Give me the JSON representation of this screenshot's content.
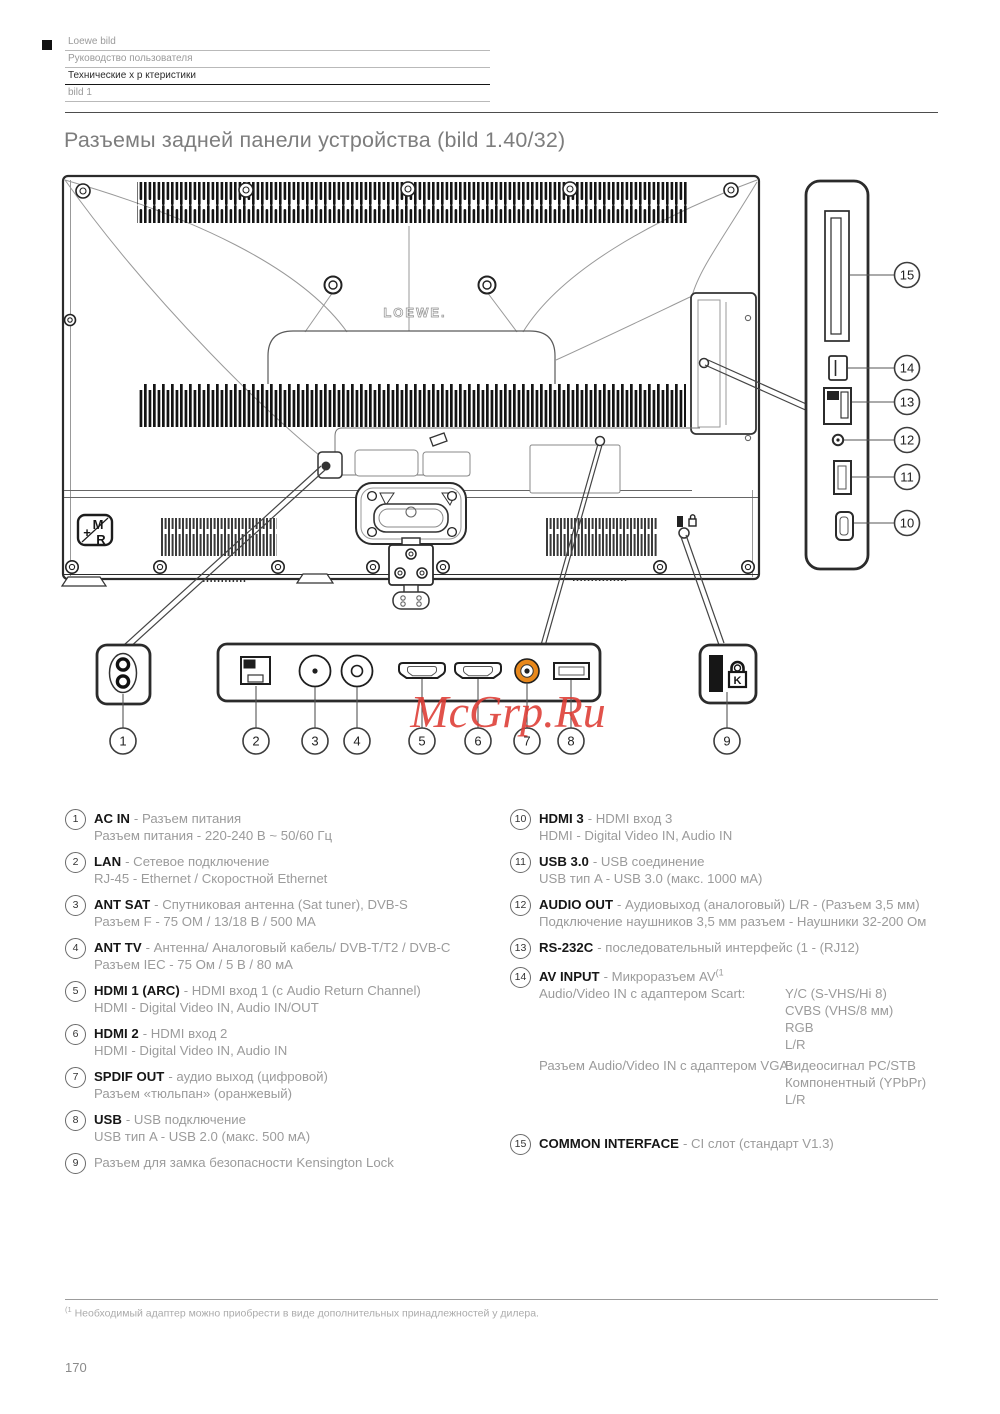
{
  "header": {
    "rows": [
      "Loewe bild",
      "Руководство пользователя",
      "Технические х р ктеристики",
      "bild 1"
    ]
  },
  "title": "Разъемы задней панели устройства (bild 1.40/32)",
  "watermark": "McGrp.Ru",
  "diagram": {
    "brand": "LOEWE.",
    "badge": [
      "M",
      "+",
      "R"
    ],
    "lock_letter": "K",
    "callouts": [
      "1",
      "2",
      "3",
      "4",
      "5",
      "6",
      "7",
      "8",
      "9",
      "10",
      "11",
      "12",
      "13",
      "14",
      "15"
    ]
  },
  "legend_left": [
    {
      "num": "1",
      "term": "AC IN",
      "desc": "- Разъем питания",
      "desc2": "Разъем питания - 220-240 В ~ 50/60 Гц"
    },
    {
      "num": "2",
      "term": "LAN",
      "desc": "- Сетевое подключение",
      "desc2": "RJ-45 - Ethernet / Скоростной Ethernet"
    },
    {
      "num": "3",
      "term": "ANT SAT",
      "desc": "- Спутниковая антенна (Sat tuner), DVB-S",
      "desc2": "Разъем F - 75 ОМ / 13/18 В / 500 МА"
    },
    {
      "num": "4",
      "term": "ANT TV",
      "desc": "- Антенна/ Аналоговый кабель/ DVB-T/T2 / DVB-C",
      "desc2": "Разъем IEC - 75 Ом / 5 В / 80 мА"
    },
    {
      "num": "5",
      "term": "HDMI 1 (ARC)",
      "desc": "- HDMI вход 1 (с Audio Return Channel)",
      "desc2": "HDMI - Digital Video IN, Audio IN/OUT"
    },
    {
      "num": "6",
      "term": "HDMI 2",
      "desc": "- HDMI вход 2",
      "desc2": "HDMI - Digital Video IN, Audio IN"
    },
    {
      "num": "7",
      "term": "SPDIF OUT",
      "desc": "- аудио выход (цифровой)",
      "desc2": "Разъем «тюльпан» (оранжевый)"
    },
    {
      "num": "8",
      "term": "USB",
      "desc": "- USB подключение",
      "desc2": "USB тип A - USB 2.0 (макс. 500 мА)"
    },
    {
      "num": "9",
      "desc": "Разъем для замка безопасности Kensington Lock"
    }
  ],
  "legend_right": [
    {
      "num": "10",
      "term": "HDMI 3",
      "desc": "- HDMI вход 3",
      "desc2": "HDMI - Digital Video IN, Audio IN"
    },
    {
      "num": "11",
      "term": "USB 3.0",
      "desc": "- USB соединение",
      "desc2": "USB тип A - USB 3.0 (макс. 1000 мА)"
    },
    {
      "num": "12",
      "term": "AUDIO OUT",
      "desc": "- Аудиовыход (аналоговый) L/R - (Разъем 3,5 мм)",
      "desc2": "Подключение наушников 3,5 мм разъем - Наушники 32-200 Ом"
    },
    {
      "num": "13",
      "term": "RS-232C",
      "desc": "- последовательный интерфейс (1 - (RJ12)"
    },
    {
      "num": "14",
      "term": "AV INPUT",
      "desc": "- Микроразъем AV",
      "sup": "(1",
      "scart_label": "Audio/Video IN с адаптером Scart:",
      "scart_values": [
        "Y/C (S-VHS/Hi 8)",
        "CVBS (VHS/8 мм)",
        "RGB",
        "L/R"
      ],
      "vga_label": "Разъем Audio/Video IN с адаптером VGA:",
      "vga_values": [
        "Видеосигнал PC/STB",
        "Компонентный (YPbPr)",
        "L/R"
      ]
    },
    {
      "num": "15",
      "term": "COMMON INTERFACE",
      "desc": "- CI слот (стандарт V1.3)"
    }
  ],
  "footnote": {
    "sup": "(1",
    "text": " Необходимый адаптер можно приобрести в виде дополнительных принадлежностей у дилера."
  },
  "page_number": "170",
  "colors": {
    "watermark_red": "#DD3B33",
    "spdif_orange": "#E8881B"
  }
}
